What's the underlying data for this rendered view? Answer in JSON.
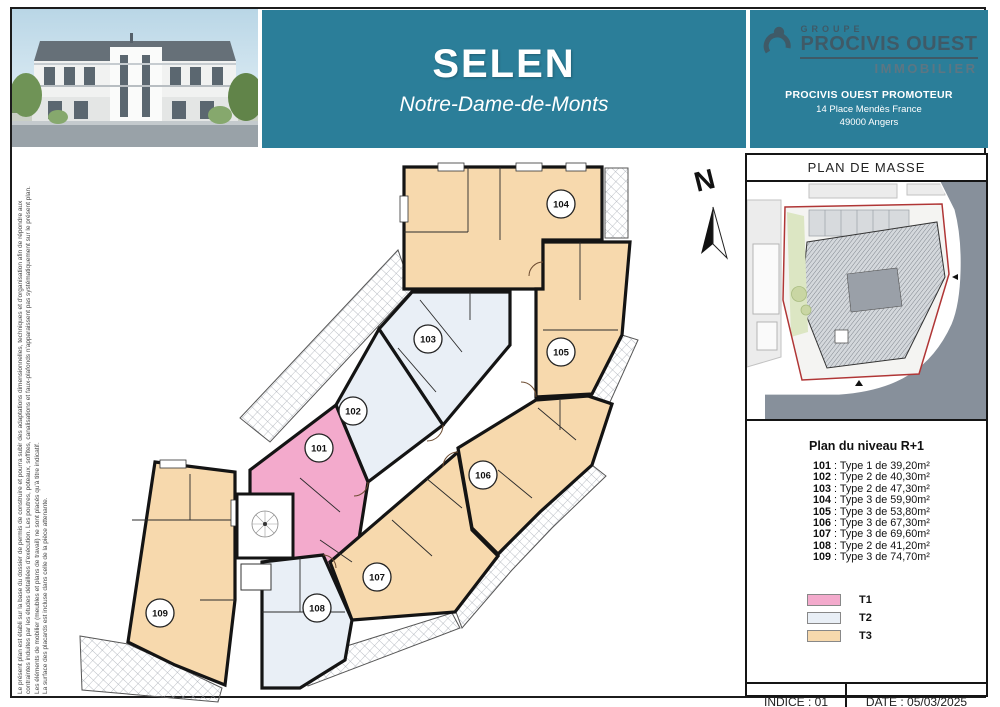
{
  "header": {
    "project_title": "SELEN",
    "project_subtitle": "Notre-Dame-de-Monts",
    "banner_color": "#2b7e99",
    "brand": {
      "group": "GROUPE",
      "name": "PROCIVIS OUEST",
      "division": "IMMOBILIER",
      "promoter": "PROCIVIS OUEST PROMOTEUR",
      "address_line1": "14 Place Mendès France",
      "address_line2": "49000 Angers",
      "logo_color": "#3f5a67"
    }
  },
  "disclaimer": {
    "line1": "Le présent plan est établi sur la base du dossier de permis de construire et pourra subir des adaptations dimensionnelles, techniques et d'organisation afin de répondre aux",
    "line2": "contraintes induites par les études détaillées d'exécution. Les poutres, poteaux, soffites, canalisations et faux-plafonds n'apparaissent pas systématiquement sur le présent plan.",
    "line3": "Les éléments de mobilier (meubles et plans de travail) ne sont placés qu'à titre indicatif.",
    "line4": "La surface des placards est incluse dans celle de la pièce attenante."
  },
  "floor_plan": {
    "north_label": "N",
    "units": [
      {
        "number": "101",
        "type": "T1"
      },
      {
        "number": "102",
        "type": "T2"
      },
      {
        "number": "103",
        "type": "T2"
      },
      {
        "number": "104",
        "type": "T3"
      },
      {
        "number": "105",
        "type": "T3"
      },
      {
        "number": "106",
        "type": "T3"
      },
      {
        "number": "107",
        "type": "T3"
      },
      {
        "number": "108",
        "type": "T2"
      },
      {
        "number": "109",
        "type": "T3"
      }
    ]
  },
  "side_panel": {
    "masse_title": "PLAN DE MASSE",
    "level_title": "Plan du niveau R+1",
    "apartments": [
      {
        "num": "101",
        "desc": " : Type 1 de 39,20m²"
      },
      {
        "num": "102",
        "desc": " : Type 2 de 40,30m²"
      },
      {
        "num": "103",
        "desc": " : Type 2 de 47,30m²"
      },
      {
        "num": "104",
        "desc": " : Type 3 de 59,90m²"
      },
      {
        "num": "105",
        "desc": " : Type 3 de 53,80m²"
      },
      {
        "num": "106",
        "desc": " : Type 3 de 67,30m²"
      },
      {
        "num": "107",
        "desc": " : Type 3 de 69,60m²"
      },
      {
        "num": "108",
        "desc": " : Type 2 de 41,20m²"
      },
      {
        "num": "109",
        "desc": " : Type 3 de 74,70m²"
      }
    ],
    "legend": [
      {
        "label": "T1",
        "color": "#f3aacc"
      },
      {
        "label": "T2",
        "color": "#e9eff6"
      },
      {
        "label": "T3",
        "color": "#f7d9ad"
      }
    ],
    "indice": "INDICE : 01",
    "date": "DATE : 05/03/2025"
  }
}
